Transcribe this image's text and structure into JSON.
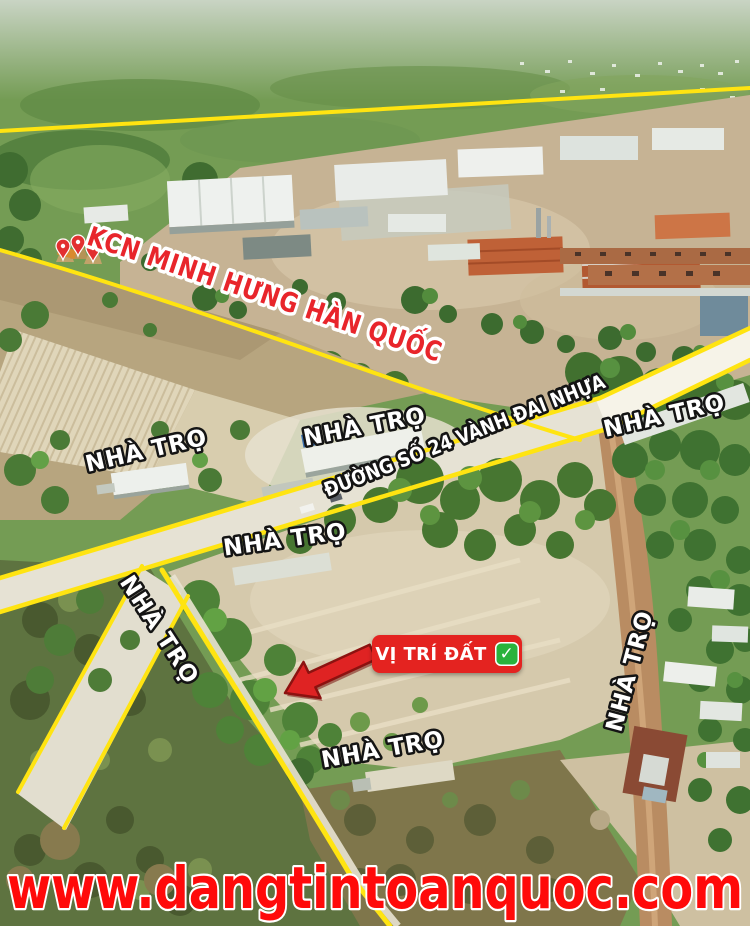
{
  "labels": {
    "industrial_zone": "KCN MINH HƯNG HÀN QUỐC",
    "road": "ĐƯỜNG SỐ 24 VÀNH ĐAI NHỰA",
    "boarding_house": "NHÀ TRỌ",
    "land_location": "VỊ TRÍ ĐẤT"
  },
  "icons": {
    "check": "✓"
  },
  "watermark": {
    "url": "www.dangtintoanquoc.com"
  },
  "colors": {
    "highlight_yellow": "#ffe411",
    "zone_label_red": "#e8252b",
    "label_white": "#ffffff",
    "label_outline_black": "#141414",
    "location_box_red": "#e42320",
    "check_green": "#2ab23c",
    "arrow_red": "#df2323",
    "watermark_red": "#ff0a0a"
  }
}
